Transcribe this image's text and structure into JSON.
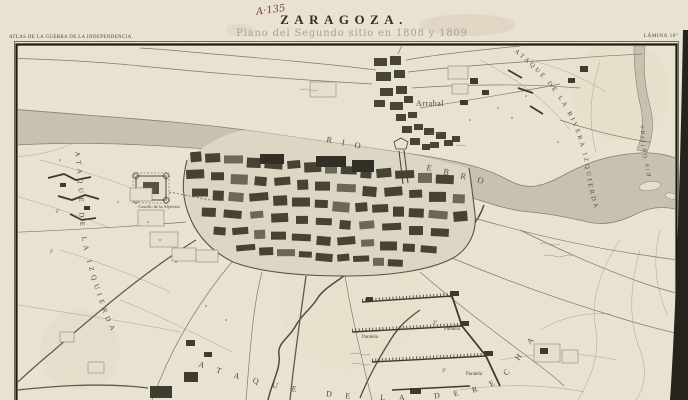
{
  "sheet": {
    "handwritten_ref": "A·135",
    "series_title": "ATLAS DE LA GUERRA DE LA INDEPENDENCIA.",
    "plate_label": "LÁMINA 10ª",
    "title": "ZARAGOZA.",
    "subtitle": "Plano del Segundo sitio en 1808 y 1809"
  },
  "map": {
    "rivers": {
      "rio": "RIO",
      "ebro": "EBRO",
      "gallego": "Rio Gallego"
    },
    "places": {
      "arrabal": "Arrabal",
      "castle": "Castillo de la Aljafería"
    },
    "operations": {
      "left_attack": "ATAQUE DE LA IZQUIERDA",
      "left_bank_attack": "ATAQUE DE LA RIVERA IZQUIERDA",
      "right_attack": "ATAQUE DE LA DERECHA"
    },
    "siege": {
      "paralela_1": "Paralela",
      "paralela_2": "Paralela",
      "paralela_3": "Paralela",
      "marker_2a": "2ª",
      "marker_3a": "3ª"
    },
    "field_markers": {
      "f1": "F",
      "f2": "F"
    }
  },
  "colors": {
    "paper": "#eae4d2",
    "ink": "#4c4839",
    "river": "#c8c3b1",
    "blocks": "#443f30",
    "block_light": "#6b6653",
    "handwriting": "#7b4438"
  }
}
